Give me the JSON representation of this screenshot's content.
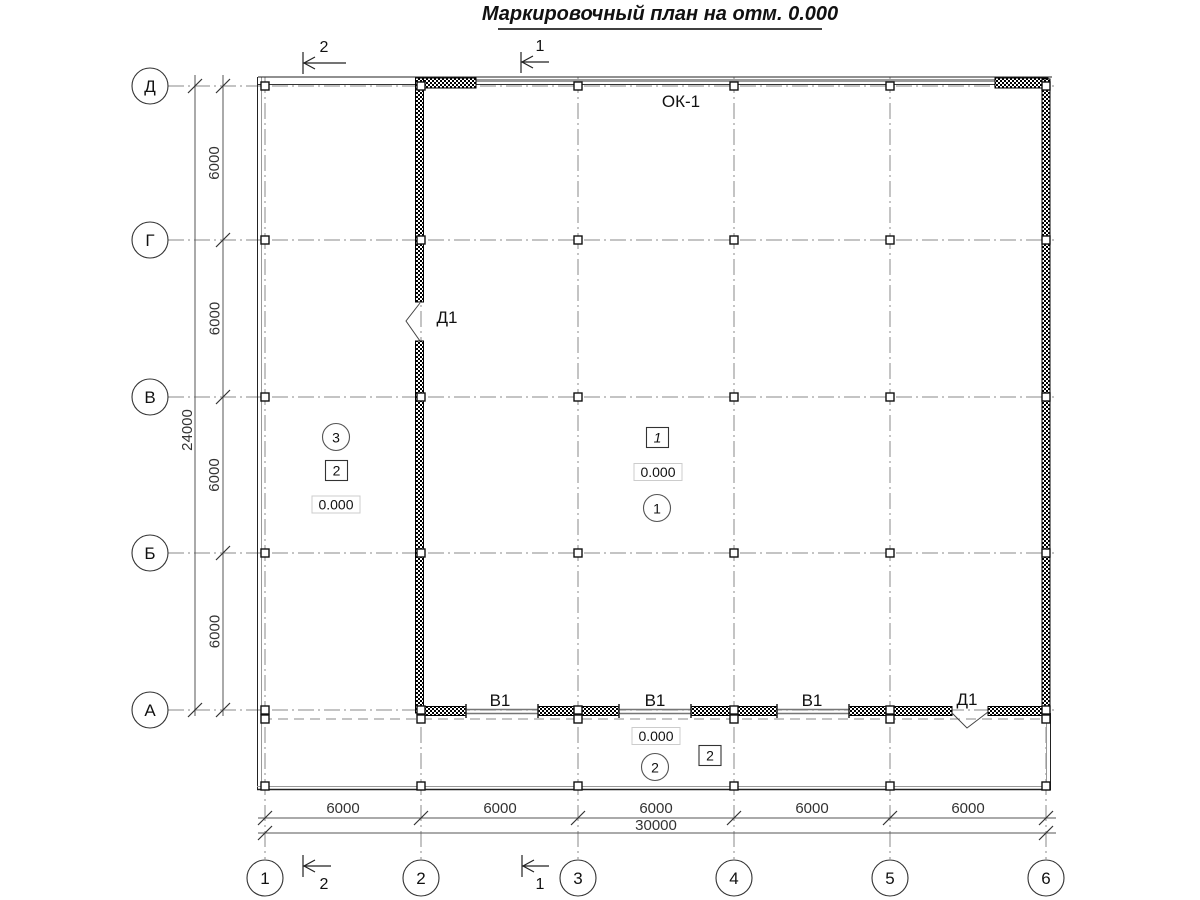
{
  "title": "Маркировочный план на отм. 0.000",
  "axes": {
    "rows": [
      "Д",
      "Г",
      "В",
      "Б",
      "А"
    ],
    "cols": [
      "1",
      "2",
      "3",
      "4",
      "5",
      "6"
    ]
  },
  "dimensions": {
    "row_spacings": [
      "6000",
      "6000",
      "6000",
      "6000"
    ],
    "row_total": "24000",
    "col_spacings": [
      "6000",
      "6000",
      "6000",
      "6000",
      "6000"
    ],
    "col_total": "30000"
  },
  "sections": {
    "top": [
      "2",
      "1"
    ],
    "bottom": [
      "2",
      "1"
    ]
  },
  "labels": {
    "window": "ОК-1",
    "door_wall": "Д1",
    "door_bottom": "Д1",
    "gates": [
      "В1",
      "В1",
      "В1"
    ]
  },
  "rooms": {
    "left": {
      "number": "3",
      "tag": "2",
      "elevation": "0.000"
    },
    "hall": {
      "tag": "1",
      "elevation": "0.000",
      "number": "1"
    },
    "annex": {
      "elevation": "0.000",
      "number": "2",
      "tag": "2"
    }
  }
}
